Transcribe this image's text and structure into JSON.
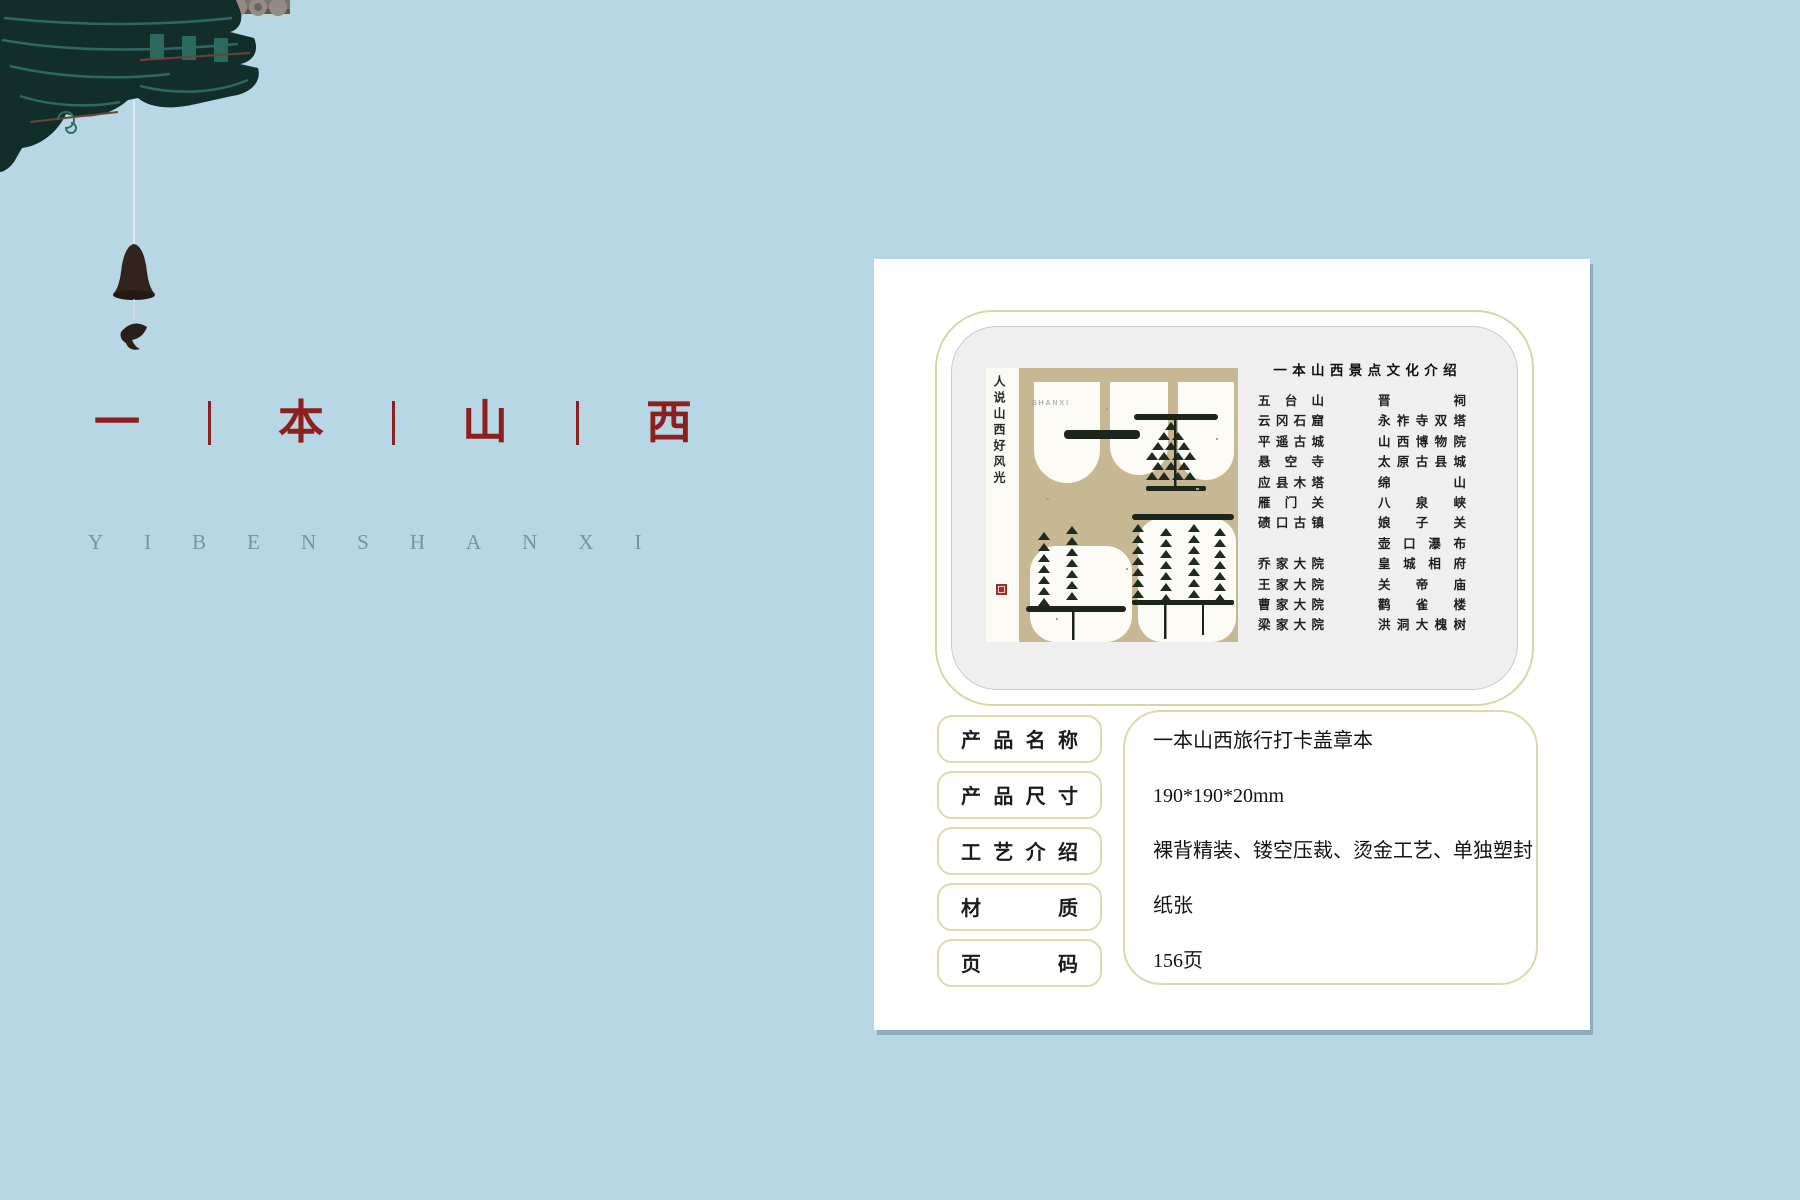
{
  "page": {
    "background_color": "#b7d7e4",
    "accent_border_color": "#dcdaa8",
    "title_color": "#8c1f1f"
  },
  "decor": {
    "eave_icon": "chinese-roof-eave",
    "bell_icon": "wind-bell",
    "fish_icon": "fish-pendant"
  },
  "brand": {
    "title_chars": [
      "一",
      "本",
      "山",
      "西"
    ],
    "subtitle": "YIBENSHANXI"
  },
  "card": {
    "panel": {
      "heading": "一 本 山 西 景 点 文 化 介 绍",
      "cover": {
        "strip_text": "人说山西好风光",
        "small_text": "SHANXI"
      },
      "list": {
        "left": [
          "五 台 山",
          "云 冈 石 窟",
          "平 遥 古 城",
          "悬 空 寺",
          "应 县 木 塔",
          "雁 门 关",
          "碛 口 古 镇",
          "",
          "乔 家 大 院",
          "王 家 大 院",
          "曹 家 大 院",
          "梁 家 大 院"
        ],
        "right": [
          "晋 祠",
          "永 祚 寺 双 塔",
          "山 西 博 物 院",
          "太 原 古 县 城",
          "绵 山",
          "八 泉 峡",
          "娘 子 关",
          "壶 口 瀑 布",
          "皇 城 相 府",
          "关 帝 庙",
          "鹳 雀 楼",
          "洪 洞 大 槐 树"
        ]
      }
    },
    "specs": [
      {
        "label": "产 品 名 称",
        "value": "一本山西旅行打卡盖章本"
      },
      {
        "label": "产 品 尺 寸",
        "value": "190*190*20mm"
      },
      {
        "label": "工 艺 介 绍",
        "value": "裸背精装、镂空压裁、烫金工艺、单独塑封"
      },
      {
        "label": "材 质",
        "value": "纸张"
      },
      {
        "label": "页 码",
        "value": "156页"
      }
    ]
  }
}
